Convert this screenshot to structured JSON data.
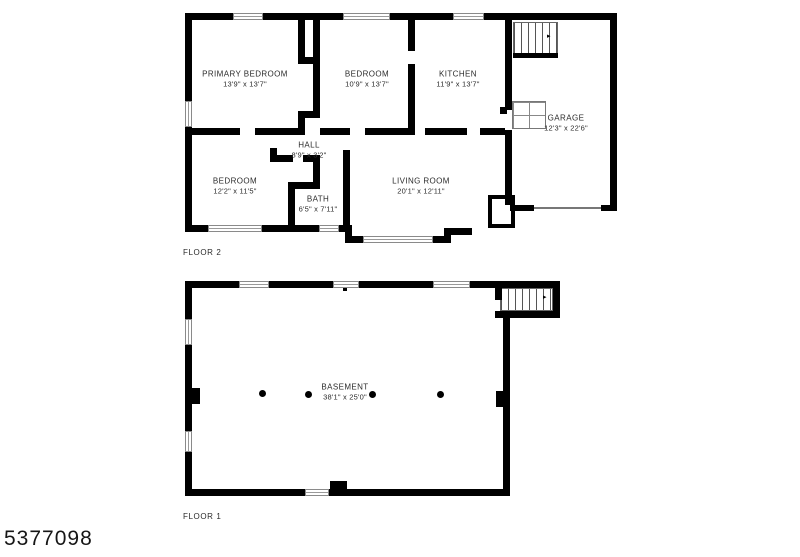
{
  "photo_id": "5377098",
  "floor2": {
    "label": "FLOOR 2",
    "rooms": {
      "primary_bedroom": {
        "name": "PRIMARY BEDROOM",
        "dims": "13'9\" x 13'7\""
      },
      "bedroom2": {
        "name": "BEDROOM",
        "dims": "10'9\" x 13'7\""
      },
      "kitchen": {
        "name": "KITCHEN",
        "dims": "11'9\" x 13'7\""
      },
      "garage": {
        "name": "GARAGE",
        "dims": "12'3\" x 22'6\""
      },
      "hall": {
        "name": "HALL",
        "dims": "8'9\" x 3'2\""
      },
      "bedroom3": {
        "name": "BEDROOM",
        "dims": "12'2\" x 11'5\""
      },
      "bath": {
        "name": "BATH",
        "dims": "6'5\" x 7'11\""
      },
      "living_room": {
        "name": "LIVING ROOM",
        "dims": "20'1\" x 12'11\""
      }
    }
  },
  "floor1": {
    "label": "FLOOR 1",
    "rooms": {
      "basement": {
        "name": "BASEMENT",
        "dims": "38'1\" x 25'0\""
      }
    }
  }
}
